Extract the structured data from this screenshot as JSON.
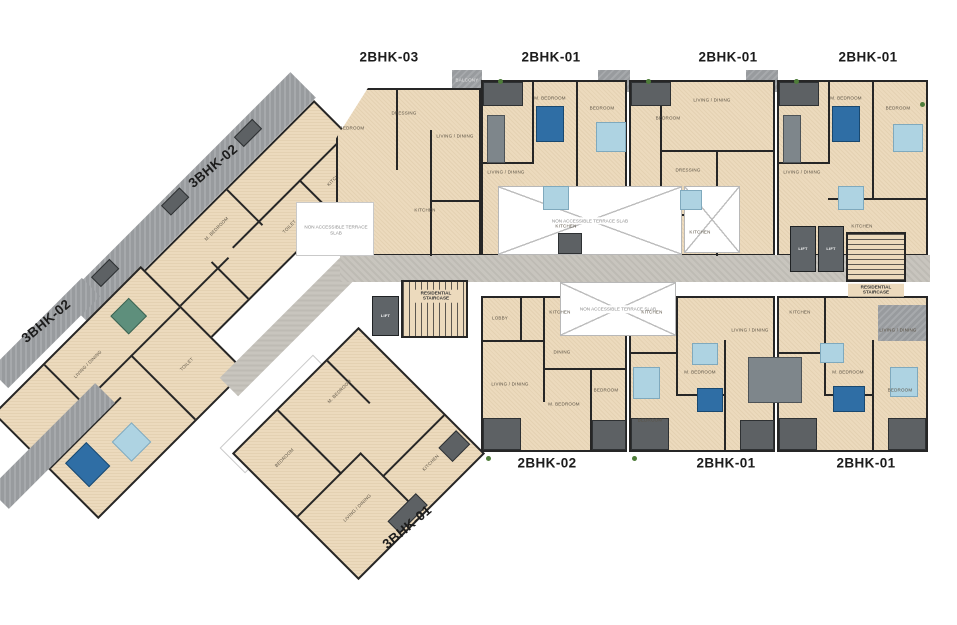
{
  "plan": {
    "units": [
      {
        "id": "2bhk-03-top",
        "label": "2BHK-03"
      },
      {
        "id": "2bhk-01-top-1",
        "label": "2BHK-01"
      },
      {
        "id": "2bhk-01-top-2",
        "label": "2BHK-01"
      },
      {
        "id": "2bhk-01-top-3",
        "label": "2BHK-01"
      },
      {
        "id": "3bhk-02-upper",
        "label": "3BHK-02"
      },
      {
        "id": "3bhk-02-lower",
        "label": "3BHK-02"
      },
      {
        "id": "2bhk-02-bottom",
        "label": "2BHK-02"
      },
      {
        "id": "2bhk-01-bottom-1",
        "label": "2BHK-01"
      },
      {
        "id": "2bhk-01-bottom-2",
        "label": "2BHK-01"
      },
      {
        "id": "3bhk-01-bottom",
        "label": "3BHK-01"
      }
    ],
    "core": {
      "staircase": "RESIDENTIAL STAIRCASE",
      "lift": "LIFT"
    },
    "notes": {
      "terrace": "NON ACCESSIBLE TERRACE SLAB"
    },
    "rooms": {
      "bedroom": "BEDROOM",
      "m_bedroom": "M. BEDROOM",
      "living": "LIVING / DINING",
      "kitchen": "KITCHEN",
      "toilet": "TOILET",
      "dressing": "DRESSING",
      "lobby": "LOBBY",
      "dining": "DINING",
      "balcony": "BALCONY"
    },
    "colors": {
      "floor": "#ecdabd",
      "wall": "#262626",
      "deck": "#989b9e",
      "deck_dark": "#5d6164",
      "corridor": "#c8c5be",
      "bed_dark": "#2f6ea5",
      "bed_light": "#aed3e2",
      "teal": "#5e8f7c",
      "label": "#1c1c1c"
    }
  }
}
